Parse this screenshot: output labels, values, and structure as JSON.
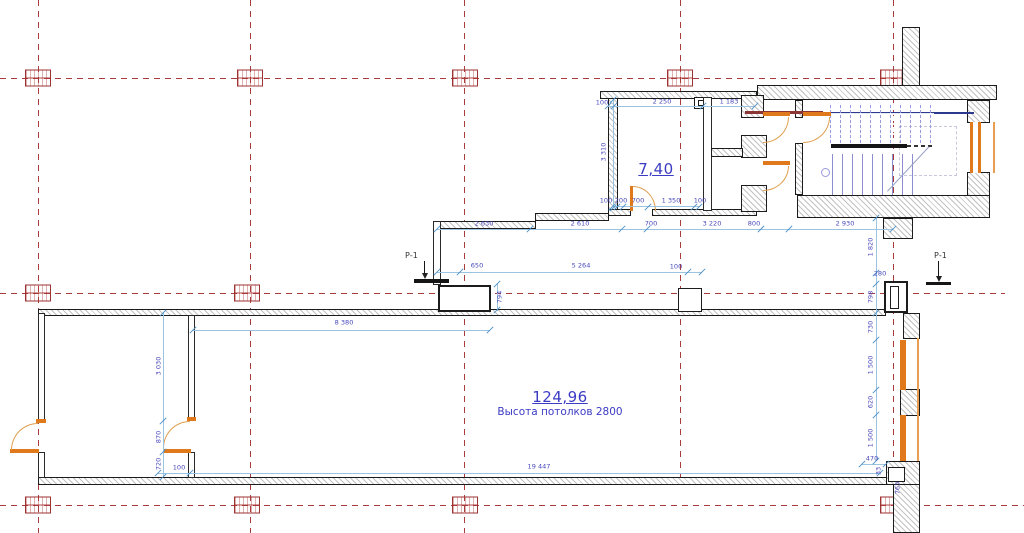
{
  "plan": {
    "rooms": [
      {
        "area_label": "7,40"
      },
      {
        "area_label": "124,96",
        "subtitle": "Высота потолков 2800"
      }
    ],
    "section_marks": [
      {
        "label": "Р-1"
      },
      {
        "label": "Р-1"
      }
    ],
    "dimensions": [
      {
        "text": "100",
        "x": 602,
        "y": 103
      },
      {
        "text": "2 250",
        "x": 662,
        "y": 102
      },
      {
        "text": "1 183",
        "x": 729,
        "y": 102
      },
      {
        "text": "3 310",
        "x": 604,
        "y": 152,
        "rot": 1
      },
      {
        "text": "100",
        "x": 606,
        "y": 201
      },
      {
        "text": "200",
        "x": 621,
        "y": 201
      },
      {
        "text": "700",
        "x": 638,
        "y": 201
      },
      {
        "text": "1 350",
        "x": 671,
        "y": 201
      },
      {
        "text": "100",
        "x": 700,
        "y": 201
      },
      {
        "text": "2 630",
        "x": 484,
        "y": 224
      },
      {
        "text": "2 610",
        "x": 580,
        "y": 224
      },
      {
        "text": "700",
        "x": 651,
        "y": 224
      },
      {
        "text": "3 220",
        "x": 712,
        "y": 224
      },
      {
        "text": "800",
        "x": 754,
        "y": 224
      },
      {
        "text": "2 930",
        "x": 845,
        "y": 224
      },
      {
        "text": "650",
        "x": 477,
        "y": 266
      },
      {
        "text": "5 264",
        "x": 581,
        "y": 266
      },
      {
        "text": "100",
        "x": 676,
        "y": 267
      },
      {
        "text": "794",
        "x": 500,
        "y": 297,
        "rot": 1
      },
      {
        "text": "1 820",
        "x": 871,
        "y": 247,
        "rot": 1
      },
      {
        "text": "280",
        "x": 880,
        "y": 274
      },
      {
        "text": "798",
        "x": 871,
        "y": 297,
        "rot": 1
      },
      {
        "text": "730",
        "x": 871,
        "y": 327,
        "rot": 1
      },
      {
        "text": "1 500",
        "x": 871,
        "y": 365,
        "rot": 1
      },
      {
        "text": "620",
        "x": 871,
        "y": 402,
        "rot": 1
      },
      {
        "text": "1 500",
        "x": 871,
        "y": 438,
        "rot": 1
      },
      {
        "text": "470",
        "x": 872,
        "y": 459
      },
      {
        "text": "33",
        "x": 879,
        "y": 471,
        "rot": 1
      },
      {
        "text": "763",
        "x": 898,
        "y": 488,
        "rot": 1
      },
      {
        "text": "8 380",
        "x": 344,
        "y": 323
      },
      {
        "text": "3 030",
        "x": 159,
        "y": 366,
        "rot": 1
      },
      {
        "text": "870",
        "x": 159,
        "y": 437,
        "rot": 1
      },
      {
        "text": "720",
        "x": 159,
        "y": 464,
        "rot": 1
      },
      {
        "text": "100",
        "x": 179,
        "y": 468
      },
      {
        "text": "19 447",
        "x": 539,
        "y": 467
      }
    ],
    "ticks": [
      [
        608,
        106
      ],
      [
        614,
        106
      ],
      [
        703,
        106
      ],
      [
        755,
        106
      ],
      [
        612,
        207
      ],
      [
        617,
        207
      ],
      [
        623,
        207
      ],
      [
        648,
        207
      ],
      [
        694,
        207
      ],
      [
        699,
        207
      ],
      [
        437,
        229
      ],
      [
        530,
        229
      ],
      [
        622,
        229
      ],
      [
        647,
        229
      ],
      [
        761,
        229
      ],
      [
        789,
        229
      ],
      [
        893,
        229
      ],
      [
        437,
        272
      ],
      [
        460,
        272
      ],
      [
        688,
        272
      ],
      [
        702,
        272
      ],
      [
        193,
        330
      ],
      [
        490,
        330
      ],
      [
        158,
        473
      ],
      [
        190,
        473
      ],
      [
        880,
        473
      ],
      [
        613,
        100
      ],
      [
        613,
        208
      ],
      [
        163,
        313
      ],
      [
        163,
        421
      ],
      [
        163,
        452
      ],
      [
        163,
        477
      ],
      [
        876,
        218
      ],
      [
        876,
        273
      ],
      [
        876,
        284
      ],
      [
        876,
        313
      ],
      [
        876,
        340
      ],
      [
        876,
        390
      ],
      [
        876,
        415
      ],
      [
        876,
        461
      ],
      [
        497,
        284
      ],
      [
        497,
        310
      ],
      [
        862,
        464
      ],
      [
        886,
        464
      ]
    ],
    "grid": {
      "verticals_x": [
        38,
        250,
        464,
        680,
        893
      ],
      "horizontals_y": [
        78,
        293,
        505
      ],
      "markers": [
        [
          38,
          78
        ],
        [
          250,
          78
        ],
        [
          465,
          78
        ],
        [
          680,
          78
        ],
        [
          893,
          78
        ],
        [
          38,
          293
        ],
        [
          247,
          293
        ],
        [
          38,
          505
        ],
        [
          247,
          505
        ],
        [
          465,
          505
        ],
        [
          893,
          505
        ]
      ]
    },
    "colors": {
      "grid_axis": "#a83b3b",
      "dimension_text": "#4747bb",
      "dimension_line": "#9cc3df",
      "wall": "#1c1c1c",
      "door_window": "#e0791c",
      "stair": "#9a9ade",
      "room_label": "#3b3bc4",
      "beam": "#8b3535",
      "landing_edge": "#2b3a8f"
    }
  }
}
